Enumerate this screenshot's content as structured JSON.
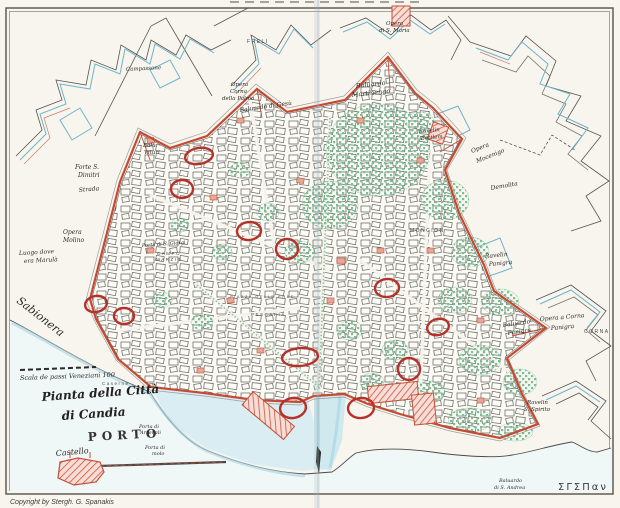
{
  "map": {
    "title_lines": [
      "Pianta della Città",
      "di Candia"
    ],
    "copyright": "Copyright by Stergh. G. Spanakis",
    "signature": "ΣΓΣΠαν",
    "scale_text": "Scala de passi Veneziani 100"
  },
  "colors": {
    "paper": "#f7f5ee",
    "ink": "#3c3b38",
    "wall_red": "#c44a33",
    "marker_red": "#b5312a",
    "outwork_blue": "#6fb3c8",
    "water": "#d9edf2",
    "garden_green": "#79c096"
  },
  "labels": [
    {
      "t": "Pianta della Città",
      "x": 42,
      "y": 401,
      "s": 12,
      "r": -4,
      "c": "title"
    },
    {
      "t": "di Candia",
      "x": 62,
      "y": 420,
      "s": 12,
      "r": -4,
      "c": "title"
    },
    {
      "t": "PORTO",
      "x": 88,
      "y": 441,
      "s": 12,
      "r": -3,
      "c": "porto"
    },
    {
      "t": "Castello",
      "x": 56,
      "y": 456,
      "s": 8,
      "r": -5,
      "c": "script"
    },
    {
      "t": "Copyright by Stergh. G. Spanakis",
      "x": 10,
      "y": 504,
      "s": 7,
      "r": 0,
      "c": "sans"
    },
    {
      "t": "ΣΓΣΠαν",
      "x": 558,
      "y": 490,
      "s": 10,
      "r": 0,
      "c": "sig"
    },
    {
      "t": "Sabionera",
      "x": 16,
      "y": 302,
      "s": 11,
      "r": 38,
      "c": "script"
    },
    {
      "t": "Scala de passi Veneziani 100",
      "x": 20,
      "y": 380,
      "s": 6.5,
      "r": -2,
      "c": "script"
    },
    {
      "t": "Luogo dove",
      "x": 19,
      "y": 255,
      "s": 6,
      "r": -3,
      "c": "script"
    },
    {
      "t": "era Marulà",
      "x": 24,
      "y": 263,
      "s": 6,
      "r": -3,
      "c": "script"
    },
    {
      "t": "Opera",
      "x": 63,
      "y": 234,
      "s": 6,
      "r": 0,
      "c": "script"
    },
    {
      "t": "Molino",
      "x": 63,
      "y": 242,
      "s": 6,
      "r": 0,
      "c": "script"
    },
    {
      "t": "Forte S.",
      "x": 75,
      "y": 169,
      "s": 6,
      "r": 0,
      "c": "script"
    },
    {
      "t": "Dimitri",
      "x": 78,
      "y": 177,
      "s": 6,
      "r": 0,
      "c": "script"
    },
    {
      "t": "Strada",
      "x": 79,
      "y": 192,
      "s": 6,
      "r": -5,
      "c": "script"
    },
    {
      "t": "Balu.",
      "x": 143,
      "y": 147,
      "s": 5.5,
      "r": 0,
      "c": "script"
    },
    {
      "t": "Vituri",
      "x": 144,
      "y": 154,
      "s": 5.5,
      "r": 0,
      "c": "script"
    },
    {
      "t": "Opera",
      "x": 231,
      "y": 86,
      "s": 5.5,
      "r": 0,
      "c": "script"
    },
    {
      "t": "Corna",
      "x": 230,
      "y": 93,
      "s": 5.5,
      "r": 0,
      "c": "script"
    },
    {
      "t": "della Palma",
      "x": 222,
      "y": 100,
      "s": 5.5,
      "r": 0,
      "c": "script"
    },
    {
      "t": "Baluardo di Gesù",
      "x": 240,
      "y": 112,
      "s": 6,
      "r": -8,
      "c": "script"
    },
    {
      "t": "Baluardo",
      "x": 356,
      "y": 88,
      "s": 6.5,
      "r": -6,
      "c": "script"
    },
    {
      "t": "Martinengo",
      "x": 352,
      "y": 97,
      "s": 6.5,
      "r": -6,
      "c": "script"
    },
    {
      "t": "Opera",
      "x": 386,
      "y": 25,
      "s": 5.5,
      "r": 0,
      "c": "script"
    },
    {
      "t": "di S. Maria",
      "x": 379,
      "y": 32,
      "s": 5.5,
      "r": 0,
      "c": "script"
    },
    {
      "t": "FRELI",
      "x": 247,
      "y": 43,
      "s": 5,
      "r": 0,
      "c": "caps"
    },
    {
      "t": "Campassone",
      "x": 126,
      "y": 71,
      "s": 5.5,
      "r": -3,
      "c": "script"
    },
    {
      "t": "Opera",
      "x": 472,
      "y": 153,
      "s": 6,
      "r": -22,
      "c": "script"
    },
    {
      "t": "Mocenigo",
      "x": 477,
      "y": 163,
      "s": 6,
      "r": -22,
      "c": "script"
    },
    {
      "t": "Demolita",
      "x": 491,
      "y": 190,
      "s": 6,
      "r": -10,
      "c": "script"
    },
    {
      "t": "Ravelin",
      "x": 485,
      "y": 258,
      "s": 6,
      "r": -5,
      "c": "script"
    },
    {
      "t": "Panigra",
      "x": 489,
      "y": 266,
      "s": 6,
      "r": -5,
      "c": "script"
    },
    {
      "t": "Baluardo",
      "x": 503,
      "y": 327,
      "s": 6,
      "r": -8,
      "c": "script"
    },
    {
      "t": "Panigra",
      "x": 508,
      "y": 335,
      "s": 6,
      "r": -8,
      "c": "script"
    },
    {
      "t": "Opera a Corna",
      "x": 540,
      "y": 321,
      "s": 6,
      "r": -5,
      "c": "script"
    },
    {
      "t": "Panigra",
      "x": 551,
      "y": 330,
      "s": 6,
      "r": -5,
      "c": "script"
    },
    {
      "t": "CORNA",
      "x": 584,
      "y": 333,
      "s": 5,
      "r": 0,
      "c": "caps"
    },
    {
      "t": "MONCION",
      "x": 410,
      "y": 232,
      "s": 5,
      "r": 0,
      "c": "caps"
    },
    {
      "t": "Ravelin",
      "x": 419,
      "y": 133,
      "s": 5.5,
      "r": -5,
      "c": "script"
    },
    {
      "t": "Bettlem",
      "x": 421,
      "y": 140,
      "s": 5.5,
      "r": -5,
      "c": "script"
    },
    {
      "t": "Porta di S. Giorgi",
      "x": 142,
      "y": 247,
      "s": 5,
      "r": -4,
      "c": "script"
    },
    {
      "t": "CAMPO",
      "x": 157,
      "y": 255,
      "s": 4.5,
      "r": 0,
      "c": "caps"
    },
    {
      "t": "MARZIO",
      "x": 156,
      "y": 261,
      "s": 4.5,
      "r": 0,
      "c": "caps"
    },
    {
      "t": "Porta di",
      "x": 139,
      "y": 428,
      "s": 5,
      "r": 0,
      "c": "script"
    },
    {
      "t": "Arsenali",
      "x": 140,
      "y": 434,
      "s": 5,
      "r": 0,
      "c": "script"
    },
    {
      "t": "Porta di",
      "x": 145,
      "y": 449,
      "s": 5,
      "r": 0,
      "c": "script"
    },
    {
      "t": "molo",
      "x": 152,
      "y": 455,
      "s": 5,
      "r": 0,
      "c": "script"
    },
    {
      "t": "PESCARIA",
      "x": 251,
      "y": 316,
      "s": 4.5,
      "r": 0,
      "c": "caps"
    },
    {
      "t": "PIAZZA DELLE ERBE",
      "x": 230,
      "y": 298,
      "s": 4,
      "r": 0,
      "c": "caps"
    },
    {
      "t": "Caserne",
      "x": 102,
      "y": 385,
      "s": 4.5,
      "r": 0,
      "c": "caps"
    },
    {
      "t": "Ravelin",
      "x": 527,
      "y": 404,
      "s": 5.5,
      "r": 0,
      "c": "script"
    },
    {
      "t": "S. Spirito",
      "x": 524,
      "y": 411,
      "s": 5.5,
      "r": 0,
      "c": "script"
    },
    {
      "t": "Baluardo",
      "x": 499,
      "y": 482,
      "s": 5,
      "r": 0,
      "c": "script"
    },
    {
      "t": "di S. Andrea",
      "x": 494,
      "y": 489,
      "s": 5,
      "r": 0,
      "c": "script"
    }
  ],
  "markers": [
    {
      "cx": 199,
      "cy": 156,
      "rx": 14,
      "ry": 8,
      "r": -10
    },
    {
      "cx": 182,
      "cy": 189,
      "rx": 11,
      "ry": 9,
      "r": 0
    },
    {
      "cx": 249,
      "cy": 231,
      "rx": 12,
      "ry": 9,
      "r": -5
    },
    {
      "cx": 287,
      "cy": 249,
      "rx": 11,
      "ry": 10,
      "r": 0
    },
    {
      "cx": 96,
      "cy": 304,
      "rx": 11,
      "ry": 8,
      "r": -12
    },
    {
      "cx": 124,
      "cy": 316,
      "rx": 10,
      "ry": 8,
      "r": 0
    },
    {
      "cx": 387,
      "cy": 288,
      "rx": 12,
      "ry": 9,
      "r": -5
    },
    {
      "cx": 438,
      "cy": 327,
      "rx": 11,
      "ry": 8,
      "r": -15
    },
    {
      "cx": 409,
      "cy": 369,
      "rx": 11,
      "ry": 11,
      "r": 0
    },
    {
      "cx": 300,
      "cy": 357,
      "rx": 18,
      "ry": 9,
      "r": -5
    },
    {
      "cx": 293,
      "cy": 408,
      "rx": 13,
      "ry": 10,
      "r": -10
    },
    {
      "cx": 361,
      "cy": 408,
      "rx": 13,
      "ry": 10,
      "r": -5
    }
  ]
}
